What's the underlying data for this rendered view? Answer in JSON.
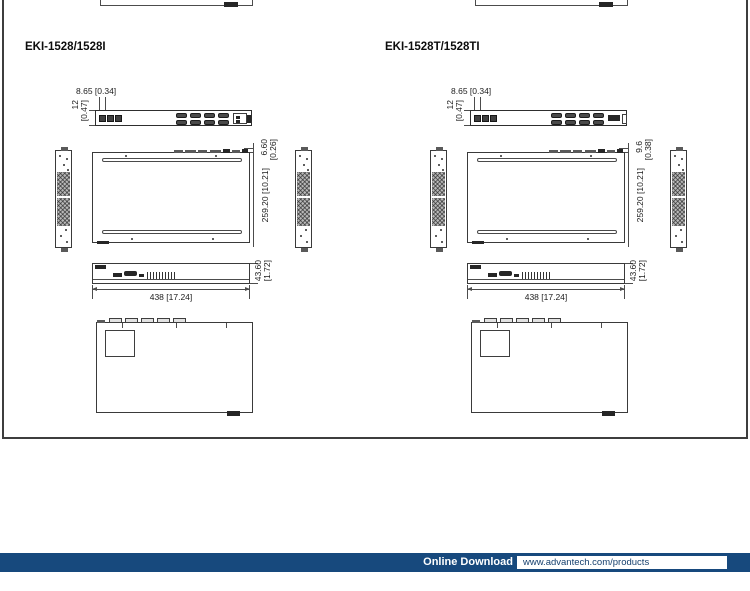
{
  "document": {
    "sections": [
      {
        "title": "EKI-1528/1528I",
        "dimensions": {
          "mount_offset": "8.65 [0.34]",
          "front_height_mm": "12",
          "front_height_in": "[0.47]",
          "rear_clearance_mm": "6.60",
          "rear_clearance_in": "[0.26]",
          "depth": "259.20 [10.21]",
          "width": "438 [17.24]",
          "height_mm": "43.60",
          "height_in": "[1.72]"
        }
      },
      {
        "title": "EKI-1528T/1528TI",
        "dimensions": {
          "mount_offset": "8.65 [0.34]",
          "front_height_mm": "12",
          "front_height_in": "[0.47]",
          "rear_clearance_mm": "9.6",
          "rear_clearance_in": "[0.38]",
          "depth": "259.20 [10.21]",
          "width": "438 [17.24]",
          "height_mm": "43.60",
          "height_in": "[1.72]"
        }
      }
    ],
    "footer": {
      "label": "Online Download",
      "url": "www.advantech.com/products"
    },
    "colors": {
      "footer_bar": "#17497D",
      "line": "#3E3E3E"
    }
  }
}
